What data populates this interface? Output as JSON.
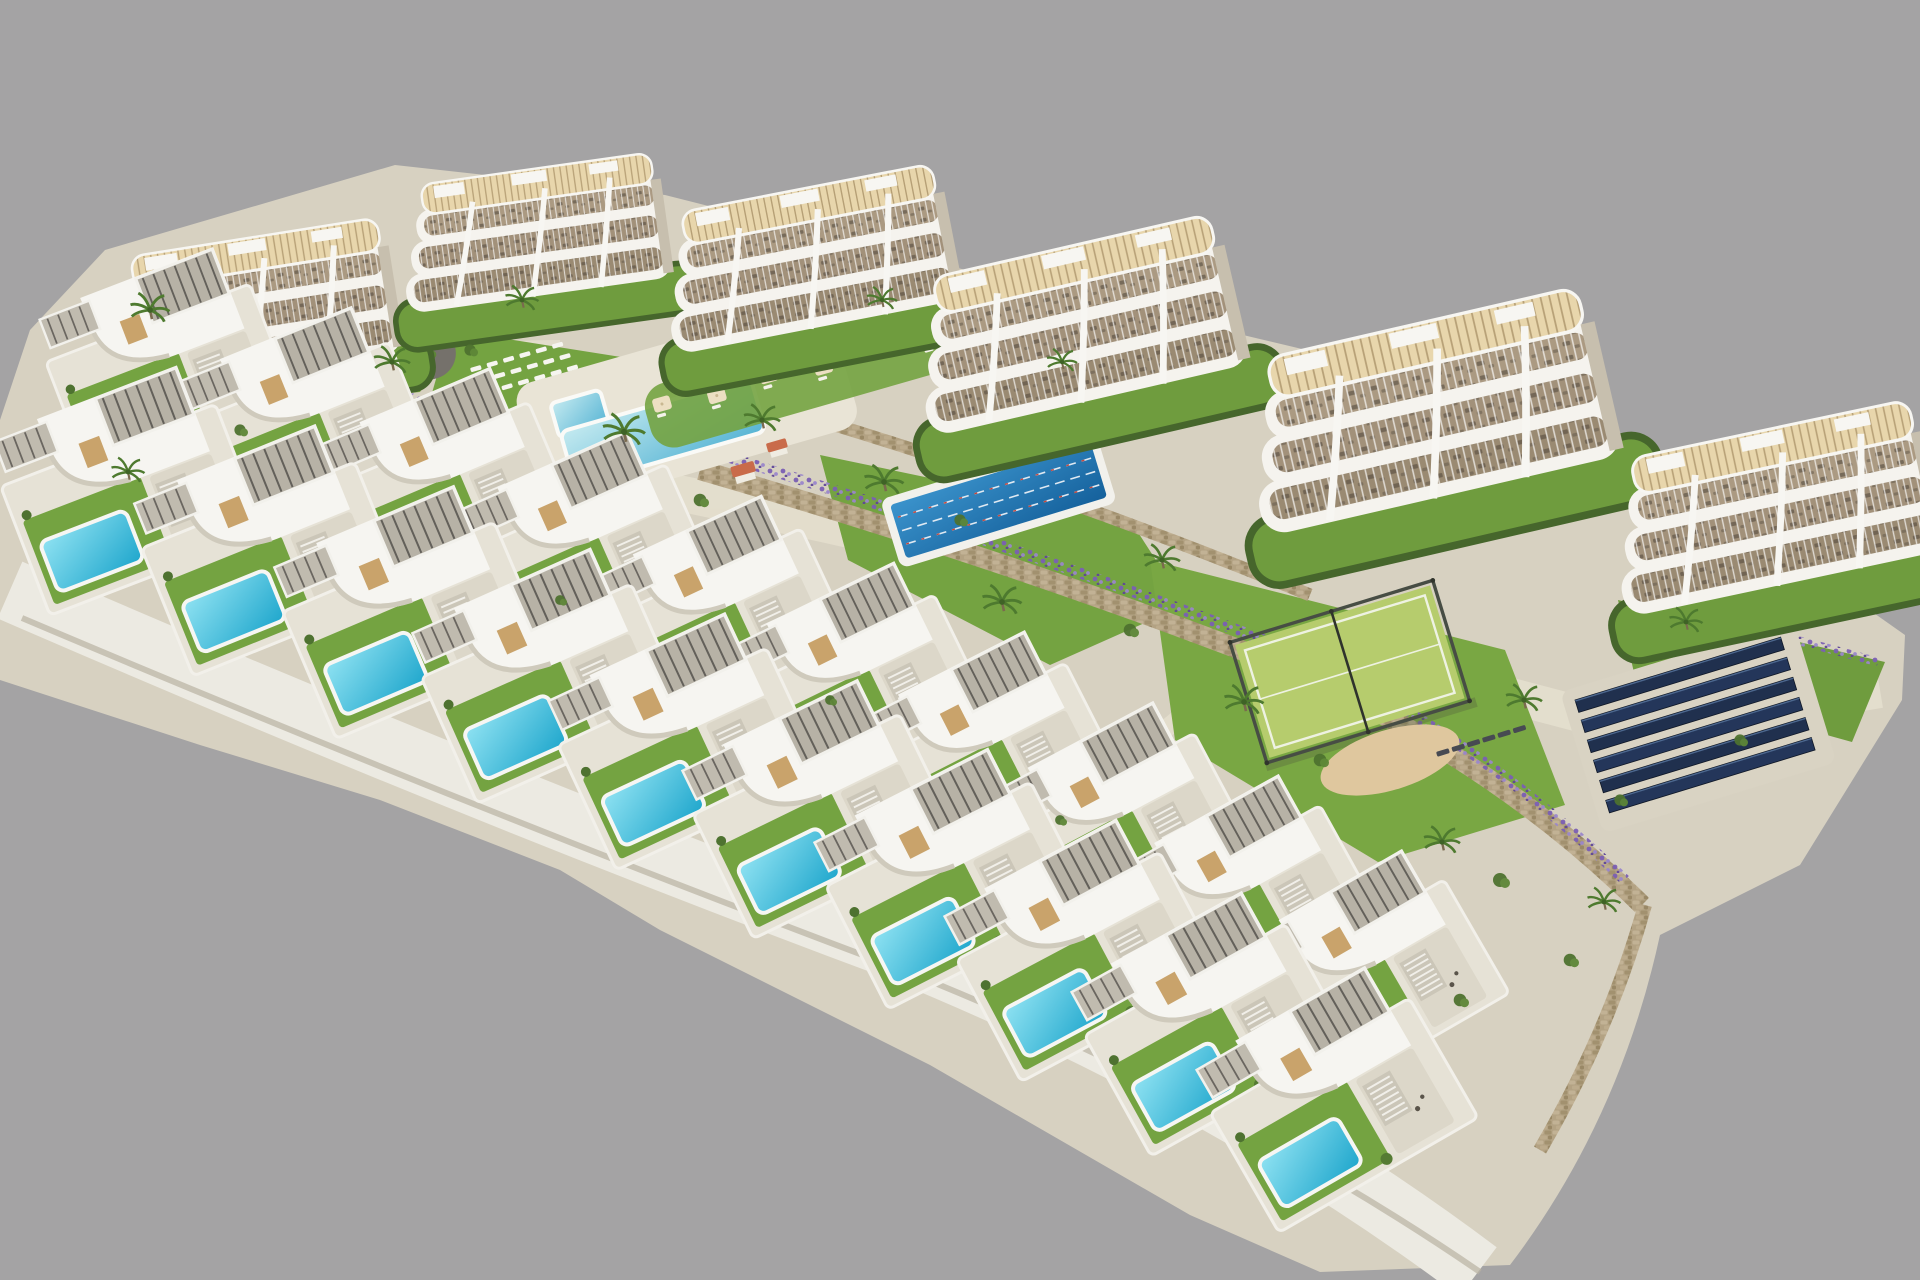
{
  "scene": {
    "kind": "aerial-3d-architectural-render",
    "description": "Aerial render of a hillside residential development: six curved white apartment buildings with rooftop wood pergolas along the top, two staggered rows of modern villas with private turquoise pools curving across the lower half, communal amenities (free-form pool with loungers and umbrellas, lane lap pool, padel court, playground, solar panel field, sand area) set among lawns, stone retaining walls, lavender beds and palm trees, all on a flat gray studio background",
    "background_color": "#a4a3a4",
    "palette": {
      "ground_path": "#d7d1c1",
      "light_walkway": "#e4decd",
      "plinth_white": "#eceae2",
      "grass": "#74a341",
      "hedge_dark": "#46662c",
      "building_white": "#f5f3ee",
      "terrace_interior": "#9a8a72",
      "roof_wood": "#e8d6ac",
      "roof_slat": "#8a6f45",
      "villa_pool_light": "#7edcef",
      "villa_pool_deep": "#1ea6cc",
      "communal_pool_light": "#b8e6ee",
      "communal_pool_deep": "#56b4d4",
      "lap_pool_light": "#3b93cc",
      "lap_pool_deep": "#15619c",
      "lane_rope_red": "#c4463c",
      "padel_surface": "#b6cc6d",
      "padel_fence": "#474d44",
      "solar_panel": "#20304e",
      "stone_wall": "#b3a283",
      "lavender": "#7b5fb4",
      "sand": "#dfc79e",
      "playground_surface": "#75716b",
      "umbrella_cream": "#ecdfc2",
      "cabana_roof_terracotta": "#c96b4a"
    },
    "counts": {
      "apartment_buildings": 6,
      "villas_back_row": 10,
      "villas_front_row": 10,
      "villa_private_pools": 10,
      "communal_pools": 1,
      "lap_pools": 1,
      "padel_courts": 1,
      "playgrounds": 1,
      "solar_panel_rows": 6,
      "umbrellas_at_pool": 7,
      "lounger_rows_at_pool": 3
    },
    "labels": {
      "background": "studio gray backdrop",
      "apartments": "curved balcony apartment block",
      "villa": "two-storey villa with slatted pergola and private pool",
      "communal_pool": "free-form community pool",
      "lap_pool": "25m lap pool with lane ropes",
      "padel_court": "fenced padel court",
      "solar_array": "photovoltaic panel field",
      "playground": "children playground",
      "stone_wall": "dry stone retaining wall",
      "lavender": "lavender planting strip"
    }
  }
}
